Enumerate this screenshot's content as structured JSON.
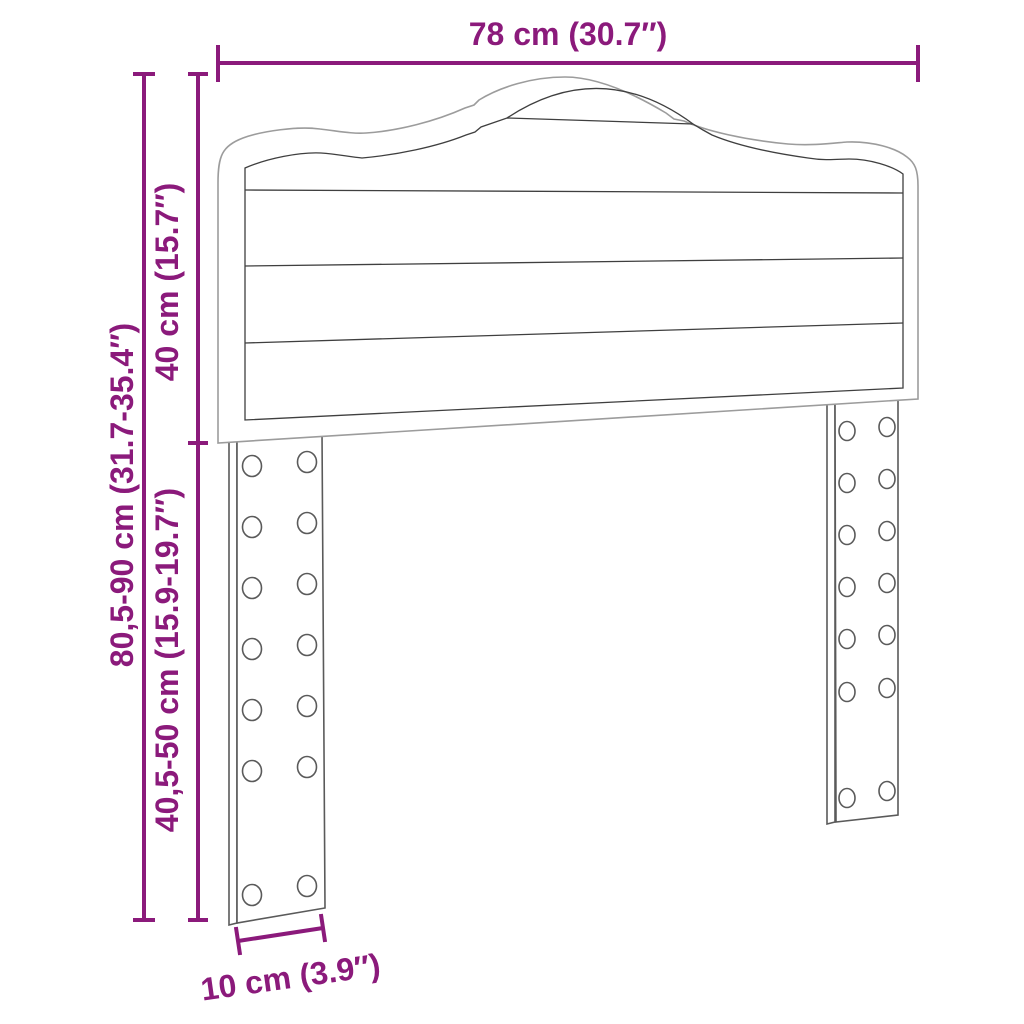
{
  "diagram": {
    "subject": "headboard-with-two-slotted-legs",
    "labels": {
      "width": "78 cm (30.7″)",
      "panel_height": "40 cm (15.7″)",
      "total_height": "80,5-90 cm (31.7-35.4″)",
      "leg_height": "40,5-50 cm (15.9-19.7″)",
      "leg_width": "10 cm (3.9″)"
    },
    "colors": {
      "dimension": "#8B1A7B",
      "outline_light": "#9C9C9C",
      "outline_dark": "#3F3F3F",
      "leg_line": "#5A5A5A",
      "background": "#FFFFFF"
    }
  }
}
